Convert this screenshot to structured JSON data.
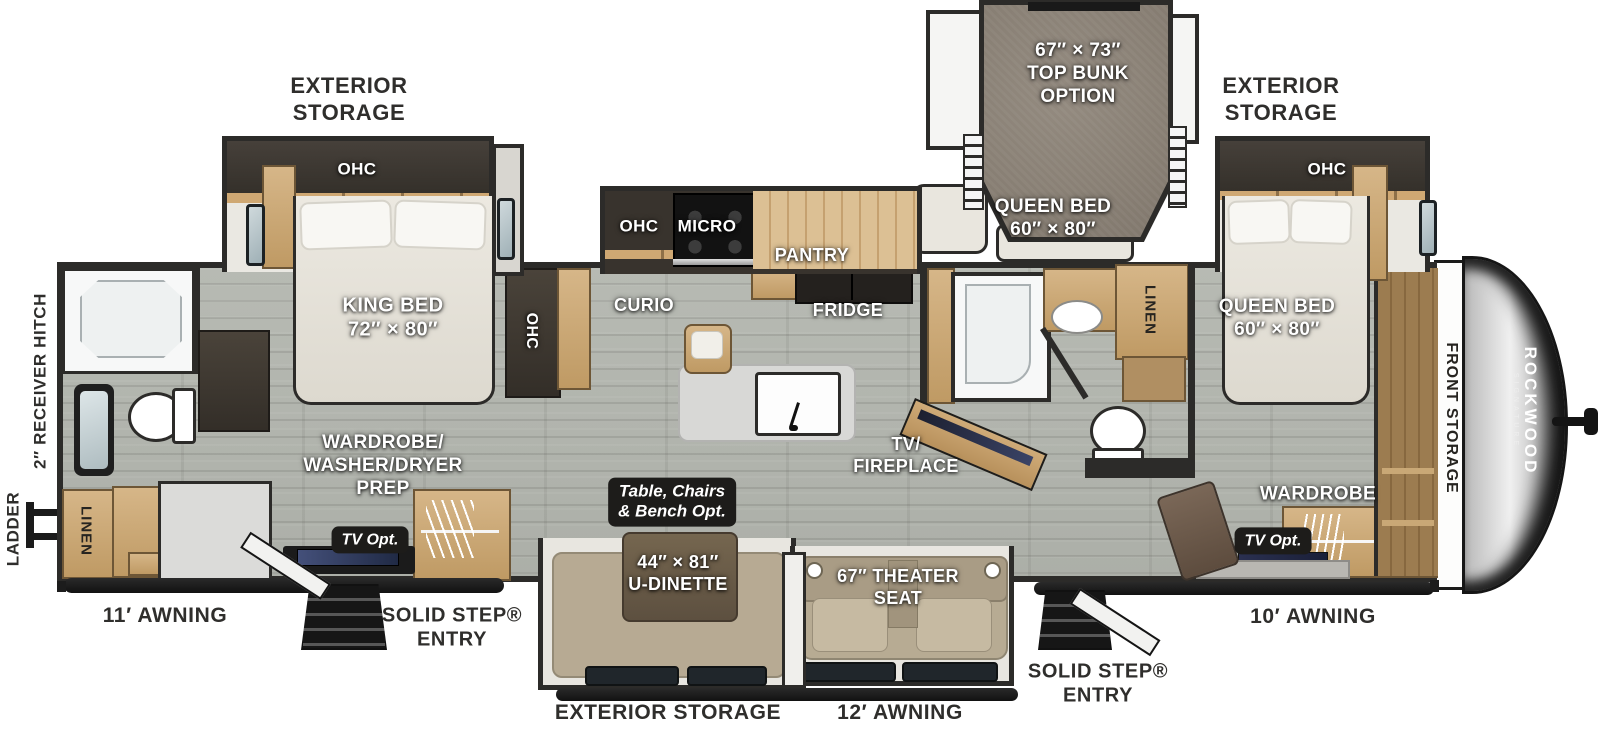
{
  "title": "Rockwood Signature Travel Trailer Floorplan",
  "brand": {
    "name": "ROCKWOOD",
    "series": "SIGNATURE"
  },
  "exterior": {
    "storage_rear_top": "EXTERIOR\nSTORAGE",
    "storage_front_top": "EXTERIOR\nSTORAGE",
    "storage_bottom": "EXTERIOR STORAGE",
    "awning_rear": "11′ AWNING",
    "awning_center": "12′ AWNING",
    "awning_front": "10′ AWNING",
    "entry_rear": "SOLID STEP®\nENTRY",
    "entry_front": "SOLID STEP®\nENTRY",
    "ladder": "LADDER",
    "receiver_hitch": "2″ RECEIVER HITCH",
    "front_storage": "FRONT STORAGE"
  },
  "bunk_room": {
    "size": "67″ × 73″\nTOP BUNK\nOPTION",
    "bed": "QUEEN BED\n60″ × 80″"
  },
  "king_bedroom": {
    "ohc": "OHC",
    "bed": "KING BED\n72″ × 80″",
    "closet": "WARDROBE/\nWASHER/DRYER\nPREP",
    "tv_opt": "TV Opt.",
    "hall_ohc": "OHC"
  },
  "rear_bath": {
    "linen": "LINEN"
  },
  "kitchen": {
    "ohc": "OHC",
    "micro": "MICRO",
    "pantry": "PANTRY",
    "curio": "CURIO",
    "fridge": "FRIDGE"
  },
  "mid_bath": {
    "linen": "LINEN"
  },
  "living": {
    "dinette_option": "Table, Chairs\n& Bench Opt.",
    "dinette": "44″ × 81″\nU-DINETTE",
    "theater_seat": "67″ THEATER\nSEAT",
    "tv_fireplace": "TV/\nFIREPLACE"
  },
  "front_bedroom": {
    "ohc": "OHC",
    "bed": "QUEEN BED\n60″ × 80″",
    "wardrobe": "WARDROBE",
    "tv_opt": "TV Opt."
  }
}
